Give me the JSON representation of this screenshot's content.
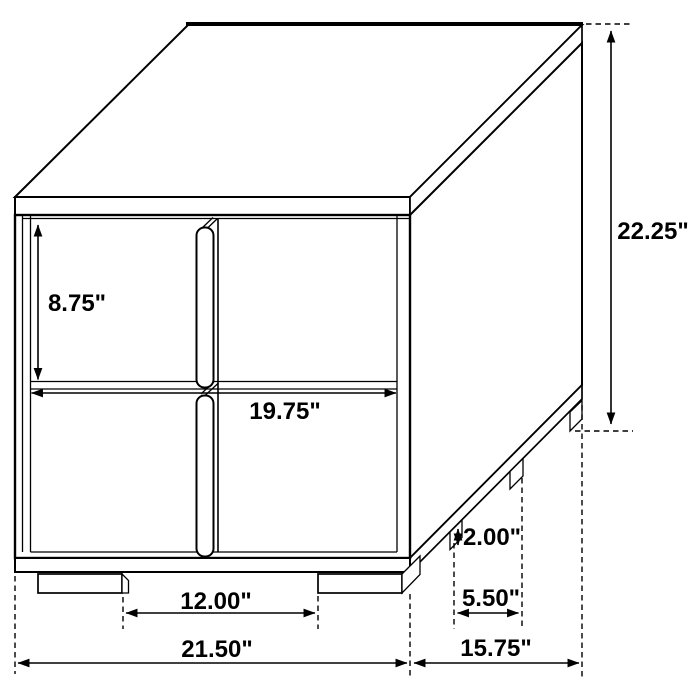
{
  "page": {
    "background": "#ffffff",
    "line_color": "#000000"
  },
  "diagram": {
    "type": "furniture-dimension-drawing",
    "subject": "two-drawer nightstand, isometric line drawing with dimension callouts",
    "unit": "inches",
    "labels": {
      "overall_height": "22.25\"",
      "drawer_height": "8.75\"",
      "interior_width": "19.75\"",
      "front_leg_clearance": "12.00\"",
      "overall_width": "21.50\"",
      "overall_depth": "15.75\"",
      "side_leg_spacing": "5.50\"",
      "leg_height": "2.00\""
    },
    "values_inches": {
      "overall_height": 22.25,
      "drawer_height": 8.75,
      "interior_width": 19.75,
      "front_leg_clearance": 12.0,
      "overall_width": 21.5,
      "overall_depth": 15.75,
      "side_leg_spacing": 5.5,
      "leg_height": 2.0
    }
  }
}
